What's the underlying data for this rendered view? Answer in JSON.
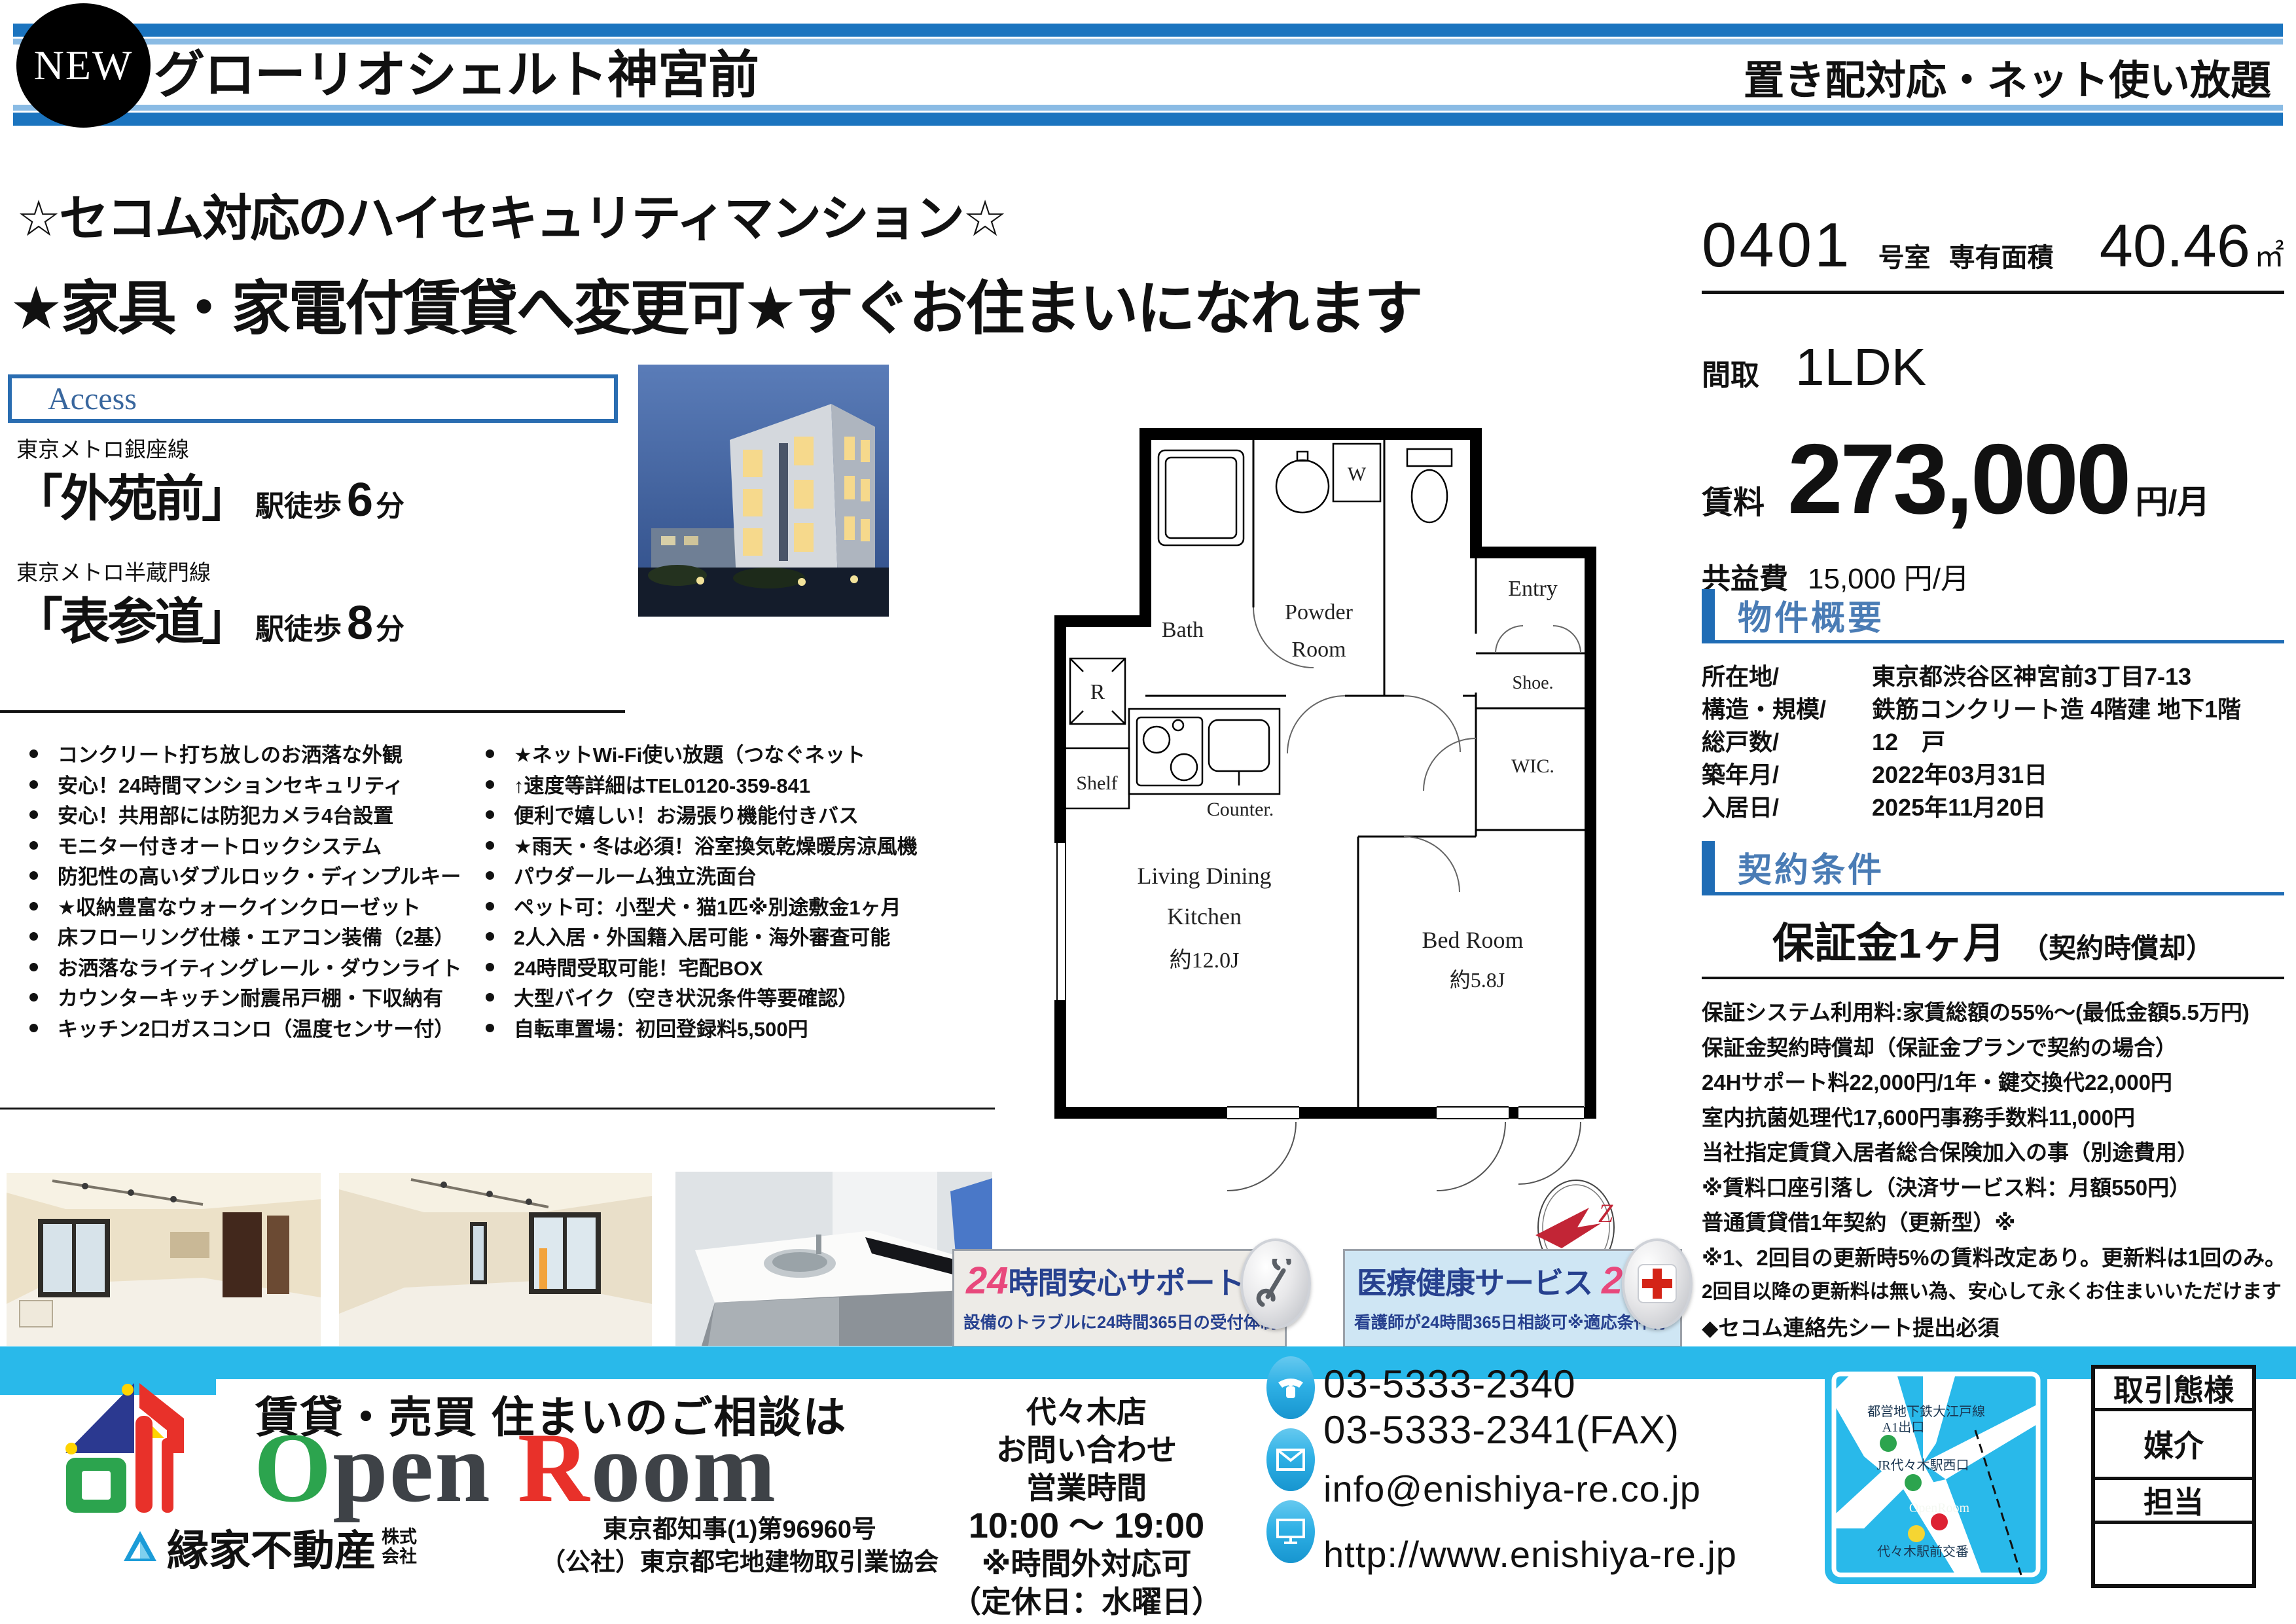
{
  "colors": {
    "stripe_blue": "#1b74bf",
    "stripe_light": "#8abbe4",
    "section_blue": "#1f6cb5",
    "cyan": "#29b9ea",
    "banner_navy": "#27418f",
    "banner_pink": "#e8487c",
    "brand_green": "#2ca44e",
    "brand_red": "#e8312a",
    "map_dot_green": "#2ca44e",
    "map_dot_red": "#dd2233",
    "map_dot_yellow": "#f5d532"
  },
  "header": {
    "badge": "NEW",
    "title": "グローリオシェルト神宮前",
    "tagline": "置き配対応・ネット使い放題"
  },
  "catchcopy": {
    "line1": "☆セコム対応のハイセキュリティマンション☆",
    "line2": "★家具・家電付賃貸へ変更可★すぐお住まいになれます"
  },
  "access": {
    "title": "Access",
    "stations": [
      {
        "line": "東京メトロ銀座線",
        "name": "「外苑前」",
        "walk": "駅徒歩",
        "min": "6",
        "unit": "分"
      },
      {
        "line": "東京メトロ半蔵門線",
        "name": "「表参道」",
        "walk": "駅徒歩",
        "min": "8",
        "unit": "分"
      }
    ]
  },
  "unit": {
    "room_no": "0401",
    "room_label": "号室",
    "area_label": "専有面積",
    "area_value": "40.46",
    "area_unit": "㎡",
    "layout_label": "間取",
    "layout": "1LDK",
    "rent_label": "賃料",
    "rent": "273,000",
    "rent_unit": "円/月",
    "fee_label": "共益費",
    "fee": "15,000 円/月"
  },
  "overview": {
    "title": "物件概要",
    "rows": [
      {
        "label": "所在地/",
        "value": "東京都渋谷区神宮前3丁目7-13"
      },
      {
        "label": "構造・規模/",
        "value": "鉄筋コンクリート造 4階建 地下1階"
      },
      {
        "label": "総戸数/",
        "value": "12　戸"
      },
      {
        "label": "築年月/",
        "value": "2022年03月31日"
      },
      {
        "label": "入居日/",
        "value": "2025年11月20日"
      }
    ]
  },
  "contract": {
    "title": "契約条件",
    "deposit": "保証金1ヶ月",
    "deposit_note": "（契約時償却）",
    "terms": [
      "保証システム利用料:家賃総額の55%～(最低金額5.5万円)",
      "保証金契約時償却（保証金プランで契約の場合）",
      "24Hサポート料22,000円/1年・鍵交換代22,000円",
      "室内抗菌処理代17,600円事務手数料11,000円",
      "当社指定賃貸入居者総合保険加入の事（別途費用）",
      "※賃料口座引落し（決済サービス料：月額550円）",
      "普通賃貸借1年契約（更新型）※",
      "※1、2回目の更新時5%の賃料改定あり。更新料は1回のみ。",
      "2回目以降の更新料は無い為、安心して永くお住まいいただけます",
      "◆セコム連絡先シート提出必須"
    ]
  },
  "features_left": [
    "コンクリート打ち放しのお洒落な外観",
    "安心！24時間マンションセキュリティ",
    "安心！共用部には防犯カメラ4台設置",
    "モニター付きオートロックシステム",
    "防犯性の高いダブルロック・ディンプルキー",
    "★収納豊富なウォークインクローゼット",
    "床フローリング仕様・エアコン装備（2基）",
    "お洒落なライティングレール・ダウンライト",
    "カウンターキッチン耐震吊戸棚・下収納有",
    "キッチン2口ガスコンロ（温度センサー付）"
  ],
  "features_right": [
    "★ネットWi-Fi使い放題（つなぐネット",
    "↑速度等詳細はTEL0120-359-841",
    "便利で嬉しい！お湯張り機能付きバス",
    "★雨天・冬は必須！浴室換気乾燥暖房涼風機",
    "パウダールーム独立洗面台",
    "ペット可：小型犬・猫1匹※別途敷金1ヶ月",
    "2人入居・外国籍入居可能・海外審査可能",
    "24時間受取可能！宅配BOX",
    "大型バイク（空き状況条件等要確認）",
    "自転車置場：初回登録料5,500円"
  ],
  "floorplan": {
    "bath": "Bath",
    "powder1": "Powder",
    "powder2": "Room",
    "w": "W",
    "entry": "Entry",
    "shoe": "Shoe.",
    "wic": "WIC.",
    "r": "R",
    "shelf": "Shelf",
    "counter": "Counter.",
    "ldk1": "Living Dining",
    "ldk2": "Kitchen",
    "ldk_size": "約12.0J",
    "bed": "Bed Room",
    "bed_size": "約5.8J"
  },
  "banners": [
    {
      "num": "24",
      "title": "時間安心サポート",
      "sub": "設備のトラブルに24時間365日の受付体制"
    },
    {
      "title": "医療健康サービス",
      "num": "24",
      "sub": "看護師が24時間365日相談可※適応条件有"
    }
  ],
  "footer": {
    "slogan": "賃貸・売買 住まいのご相談は",
    "brand": {
      "o": "O",
      "pen": "pen ",
      "r": "R",
      "oom": "oom"
    },
    "company": "縁家不動産",
    "company_sfx1": "株式",
    "company_sfx2": "会社",
    "license1": "東京都知事(1)第96960号",
    "license2": "（公社）東京都宅地建物取引業協会",
    "branch_lines": [
      "代々木店",
      "お問い合わせ",
      "営業時間",
      "10:00 ～ 19:00",
      "※時間外対応可",
      "（定休日：水曜日）"
    ],
    "tel": "03-5333-2340",
    "fax": "03-5333-2341(FAX)",
    "email": "info@enishiya-re.co.jp",
    "url": "http://www.enishiya-re.jp",
    "map": {
      "labels": [
        "都営地下鉄大江戸線",
        "A1出口",
        "JR代々木駅西口",
        "OpenRoom",
        "代々木駅前交番"
      ]
    },
    "trade": {
      "header": "取引態様",
      "rows": [
        "媒介",
        "担当",
        ""
      ]
    }
  }
}
